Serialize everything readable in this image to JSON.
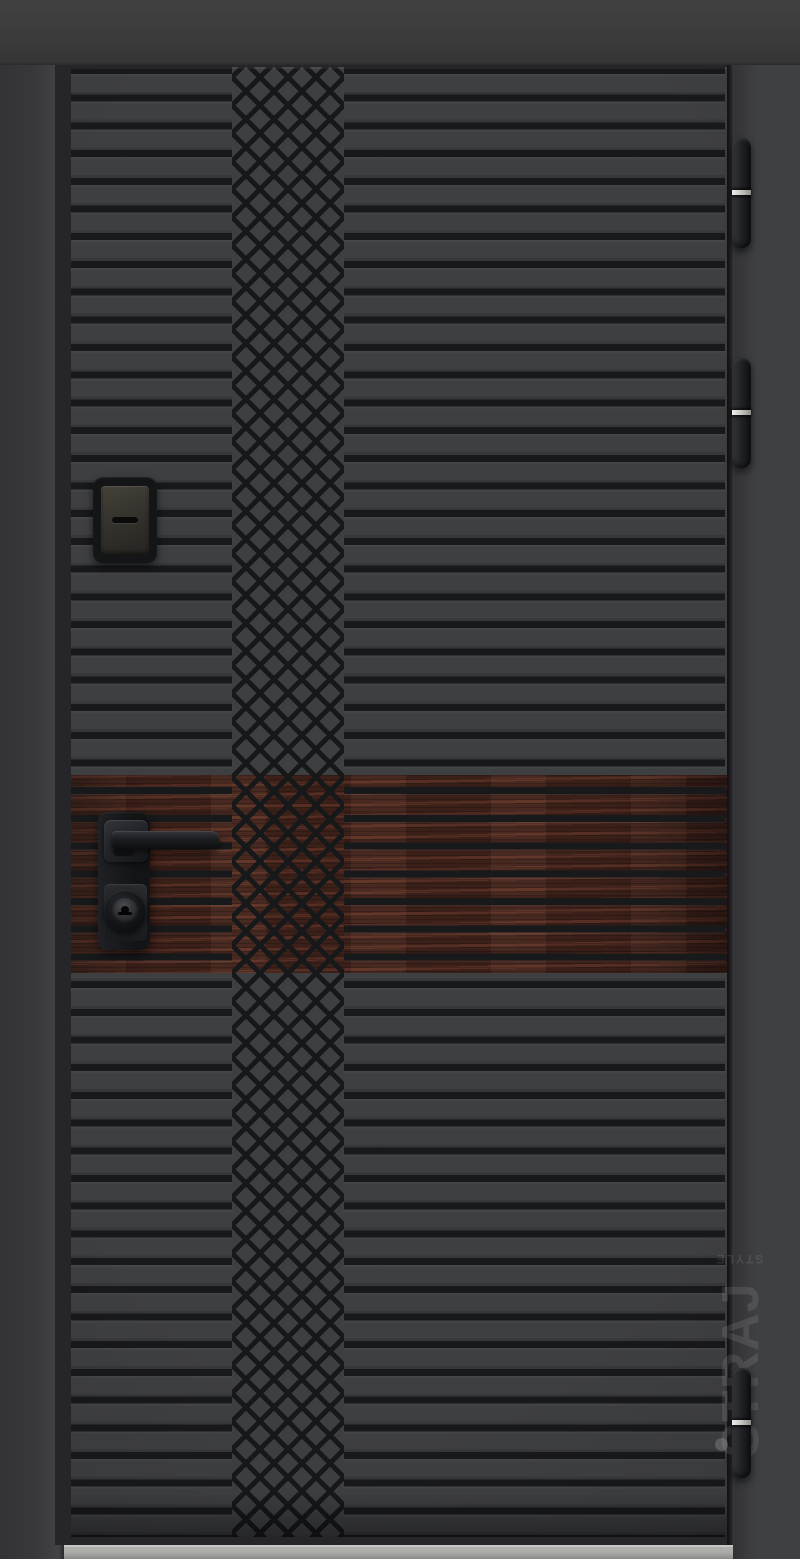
{
  "image": {
    "type": "product-photo",
    "subject": "steel entrance door with horizontal milled grooves, central diamond lattice pattern and dark wood accent band"
  },
  "watermark": {
    "brand": "STRAJ",
    "sub": "STYLE"
  },
  "door": {
    "hinge_count": 3,
    "hardware": [
      "keyhole escutcheon",
      "lever handle",
      "cylinder lock"
    ],
    "accent_band": "dark mahogany wood insert",
    "pattern": "horizontal grooves with diamond cross-hatch column"
  },
  "colors": {
    "top_bar": "#3c3c3d",
    "frame_left": "#38383a",
    "frame_right": "#3e4042",
    "door_edge": "#26262a",
    "face": "#3e3f41",
    "groove": "#18191b",
    "lattice_line": "#17181a",
    "wood": "#4e2a22",
    "hardware_dark": "#141517",
    "silver": "#c6c6c2",
    "threshold_dark": "#8b8b89",
    "gap": "#1e1e21",
    "watermark": "rgba(208,208,215,0.13)",
    "watermark_dot": "rgba(210,210,216,0.22)"
  }
}
